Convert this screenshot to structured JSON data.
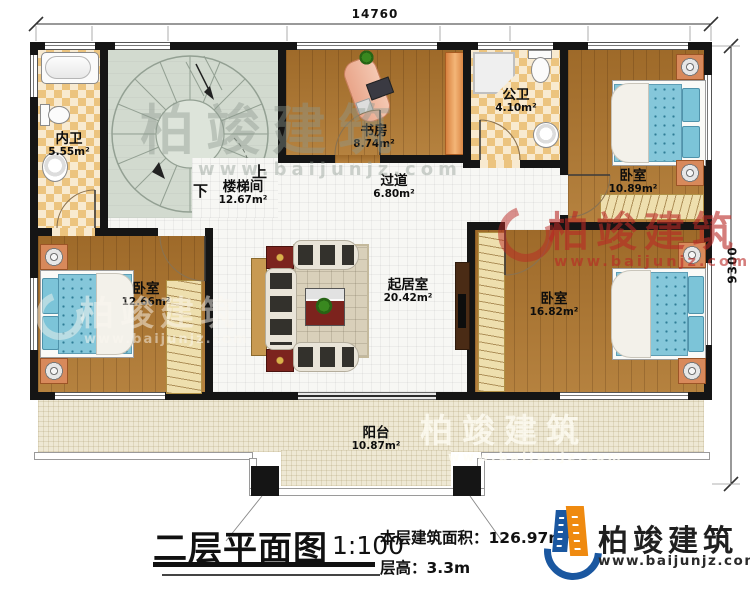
{
  "plan": {
    "rooms": [
      {
        "name": "内卫",
        "area": "5.55m²"
      },
      {
        "name": "楼梯间",
        "area": "12.67m²"
      },
      {
        "name": "书房",
        "area": "8.74m²"
      },
      {
        "name": "公卫",
        "area": "4.10m²"
      },
      {
        "name": "卧室",
        "area": "10.89m²"
      },
      {
        "name": "过道",
        "area": "6.80m²"
      },
      {
        "name": "起居室",
        "area": "20.42m²"
      },
      {
        "name": "卧室",
        "area": "12.66m²"
      },
      {
        "name": "卧室",
        "area": "16.82m²"
      },
      {
        "name": "阳台",
        "area": "10.87m²"
      }
    ],
    "stair_up": "上",
    "stair_down": "下"
  },
  "dimensions": {
    "top": "14760",
    "right": "9300"
  },
  "title_block": {
    "title": "二层平面图",
    "scale": "1:100",
    "area_label": "本层建筑面积：",
    "area_value": "126.97m²",
    "height_label": "层高：",
    "height_value": "3.3m"
  },
  "branding": {
    "company": "柏竣建筑",
    "website": "www.baijunjz.com"
  },
  "colors": {
    "wall": "#151515",
    "wood_floor": "#a9732f",
    "tile": "#ecc47f",
    "stair_floor": "#d2dacf",
    "balcony": "#eee8d4",
    "bed": "#85c7da",
    "logo_blue": "#1a57a0",
    "logo_orange": "#ef8a10",
    "watermark_red": "#b92824"
  }
}
